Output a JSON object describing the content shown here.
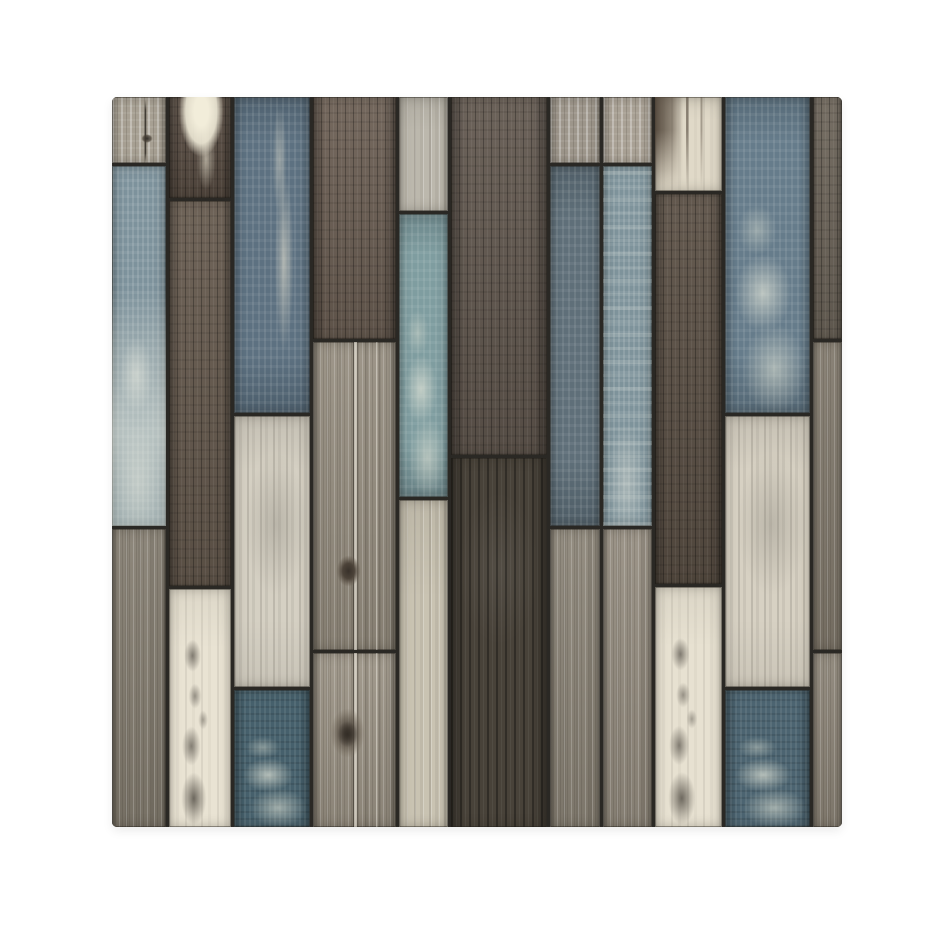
{
  "background_color": "#ffffff",
  "panel": {
    "left": 112,
    "top": 97,
    "width": 730,
    "height": 730,
    "seam_color": "#2a2824",
    "corner_radius": 5,
    "columns": [
      {
        "x": 0,
        "w": 54,
        "segments": [
          {
            "y": 0,
            "h": 66,
            "type": "graywood-light",
            "color": "#a7a093",
            "features": [
              "crack"
            ]
          },
          {
            "y": 69,
            "h": 360,
            "type": "blue-washed",
            "color": "#7d929c",
            "features": [
              "wash-heavy"
            ]
          },
          {
            "y": 432,
            "h": 298,
            "type": "graywood-mid",
            "color": "#847d70",
            "features": []
          }
        ]
      },
      {
        "x": 57,
        "w": 62,
        "segments": [
          {
            "y": 0,
            "h": 101,
            "type": "darkbrown",
            "color": "#5a4e44",
            "features": [
              "drip-light"
            ]
          },
          {
            "y": 104,
            "h": 385,
            "type": "darktaupe",
            "color": "#675b4f",
            "features": []
          },
          {
            "y": 492,
            "h": 238,
            "type": "cream",
            "color": "#e9e3d3",
            "features": [
              "splotches"
            ]
          }
        ]
      },
      {
        "x": 122,
        "w": 76,
        "segments": [
          {
            "y": 0,
            "h": 316,
            "type": "blue-slate",
            "color": "#5d7181",
            "features": [
              "streak-light"
            ]
          },
          {
            "y": 319,
            "h": 271,
            "type": "cream-streaky",
            "color": "#d5d0c3",
            "features": []
          },
          {
            "y": 593,
            "h": 137,
            "type": "teal-dark",
            "color": "#46606c",
            "features": [
              "patch-light-low"
            ]
          }
        ]
      },
      {
        "x": 201,
        "w": 83,
        "segments": [
          {
            "y": 0,
            "h": 242,
            "type": "graybrown-dark",
            "color": "#6d6055",
            "features": []
          },
          {
            "y": 245,
            "h": 308,
            "type": "graywood-tan",
            "color": "#958d7f",
            "features": [
              "groove",
              "knot-mid"
            ]
          },
          {
            "y": 556,
            "h": 174,
            "type": "graywood-tan",
            "color": "#9a9284",
            "features": [
              "groove",
              "knot-big"
            ]
          }
        ]
      },
      {
        "x": 287,
        "w": 49,
        "segments": [
          {
            "y": 0,
            "h": 114,
            "type": "light-paint",
            "color": "#bcb8ad",
            "features": []
          },
          {
            "y": 117,
            "h": 283,
            "type": "teal-light",
            "color": "#7f9da0",
            "features": [
              "patch-light-low"
            ]
          },
          {
            "y": 403,
            "h": 327,
            "type": "light-wood",
            "color": "#c9c3b2",
            "features": []
          }
        ]
      },
      {
        "x": 339,
        "w": 96,
        "segments": [
          {
            "y": 0,
            "h": 358,
            "type": "darktaupe",
            "color": "#635950",
            "features": []
          },
          {
            "y": 361,
            "h": 369,
            "type": "charcoal",
            "color": "#484239",
            "features": []
          }
        ]
      },
      {
        "x": 438,
        "w": 50,
        "segments": [
          {
            "y": 0,
            "h": 66,
            "type": "graywood-light",
            "color": "#9d968b",
            "features": []
          },
          {
            "y": 69,
            "h": 360,
            "type": "blue-muted",
            "color": "#5f6f79",
            "features": []
          },
          {
            "y": 432,
            "h": 298,
            "type": "graywood-mid",
            "color": "#8b8477",
            "features": []
          }
        ]
      },
      {
        "x": 491,
        "w": 49,
        "segments": [
          {
            "y": 0,
            "h": 66,
            "type": "graywood-light",
            "color": "#a9a195",
            "features": []
          },
          {
            "y": 69,
            "h": 360,
            "type": "blue-washed",
            "color": "#7e939b",
            "features": [
              "bands"
            ]
          },
          {
            "y": 432,
            "h": 298,
            "type": "graywood-mid",
            "color": "#948c7f",
            "features": []
          }
        ]
      },
      {
        "x": 543,
        "w": 67,
        "segments": [
          {
            "y": 0,
            "h": 94,
            "type": "cream",
            "color": "#e0d9c8",
            "features": [
              "drip-dark"
            ]
          },
          {
            "y": 97,
            "h": 390,
            "type": "darkbrown",
            "color": "#5c5146",
            "features": []
          },
          {
            "y": 490,
            "h": 240,
            "type": "cream",
            "color": "#e7e1d1",
            "features": [
              "splotches"
            ]
          }
        ]
      },
      {
        "x": 613,
        "w": 85,
        "segments": [
          {
            "y": 0,
            "h": 316,
            "type": "blue-slate",
            "color": "#667c8b",
            "features": [
              "patch-light-low"
            ]
          },
          {
            "y": 319,
            "h": 271,
            "type": "cream-streaky",
            "color": "#d7d1c3",
            "features": []
          },
          {
            "y": 593,
            "h": 137,
            "type": "teal-dark",
            "color": "#4c6471",
            "features": [
              "patch-light-low"
            ]
          }
        ]
      },
      {
        "x": 701,
        "w": 29,
        "segments": [
          {
            "y": 0,
            "h": 242,
            "type": "graybrown-dark",
            "color": "#6f675c",
            "features": []
          },
          {
            "y": 245,
            "h": 308,
            "type": "graywood-mid",
            "color": "#827a6d",
            "features": []
          },
          {
            "y": 556,
            "h": 174,
            "type": "graywood-mid",
            "color": "#8d8578",
            "features": []
          }
        ]
      }
    ]
  }
}
